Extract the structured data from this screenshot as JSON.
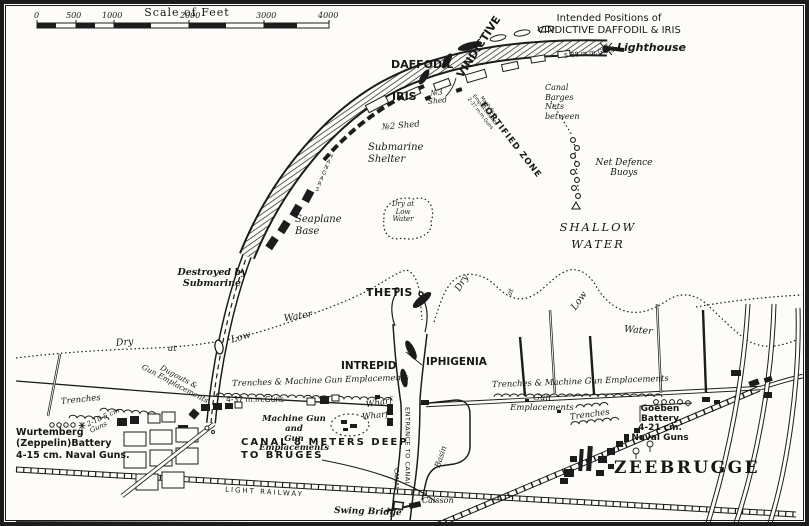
{
  "map": {
    "scale": {
      "title": "Scale of Feet",
      "ticks": [
        "0",
        "500",
        "1000",
        "2000",
        "3000",
        "4000"
      ]
    },
    "ships": {
      "vindictive": "VINDICTIVE",
      "daffodil": "DAFFODIL",
      "iris": "IRIS",
      "thetis": "THETIS",
      "intrepid": "INTREPID",
      "iphigenia": "IPHIGENIA"
    },
    "labels": {
      "intendedPositions": "Intended Positions of\nVINDICTIVE DAFFODIL & IRIS",
      "lighthouse": "Lighthouse",
      "guns88": "5-88 m.m.Guns",
      "shed3": "№3\nShed",
      "shed2": "№2 Shed",
      "fortifiedZone": "FORTIFIED ZONE",
      "machGun237": "Mach.Gun\nEmplacements\n2-37 m.m.Guns",
      "canalBarges": "Canal\nBarges\nNets\nbetween",
      "netDefenceBuoys": "Net Defence\nBuoys",
      "shallowWater": "SHALLOW\nWATER",
      "submarineShelter": "Submarine\nShelter",
      "hangars": "HANGARS",
      "seaplaneBase": "Seaplane\nBase",
      "dryIsland": "Dry at\nLow\nWater",
      "destroyedBySubmarine": "Destroyed by\nSubmarine",
      "dryWest": "Dry",
      "atWest": "at",
      "lowWest": "Low",
      "waterWest": "Water",
      "dryEast": "Dry",
      "atEast": "at",
      "lowEast": "Low",
      "waterEast": "Water",
      "trenchesMgWest": "Trenches & Machine Gun Emplacements",
      "trenchesMgEast": "Trenches & Machine Gun Emplacements",
      "guns437": "4-37 m.m.Guns",
      "machineGunAnd": "Machine Gun and\nGun Emplacements",
      "wharfUpper": "Wharf",
      "wharfLower": "Wharf",
      "entranceToCanal": "ENTRANCE TO CANAL",
      "canal8Meters": "CANAL 8 METERS DEEP\nTO BRUGES",
      "gunEmplacementsEast": "Gun\nEmplacements",
      "trenchesEast": "Trenches",
      "goebenBattery": "Goeben\nBattery\n4-21 cm.\nNaval Guns",
      "zeebrugge": "ZEEBRUGGE",
      "wurtembergBattery": "Wurtemberg\n(Zeppelin)Battery\n4-15 cm. Naval Guns.",
      "trenchesWest": "Trenches",
      "dugouts": "Dugouts &\nGun Emplacements",
      "guns105": "2-10·5 cm\nGuns",
      "lightRailway": "LIGHT RAILWAY",
      "swingBridge": "Swing Bridge",
      "caisson": "Caisson",
      "canalVertical": "CANAL",
      "basin": "Basin"
    },
    "colors": {
      "ink": "#1c1c1c",
      "paper": "#fdfcf8"
    }
  }
}
